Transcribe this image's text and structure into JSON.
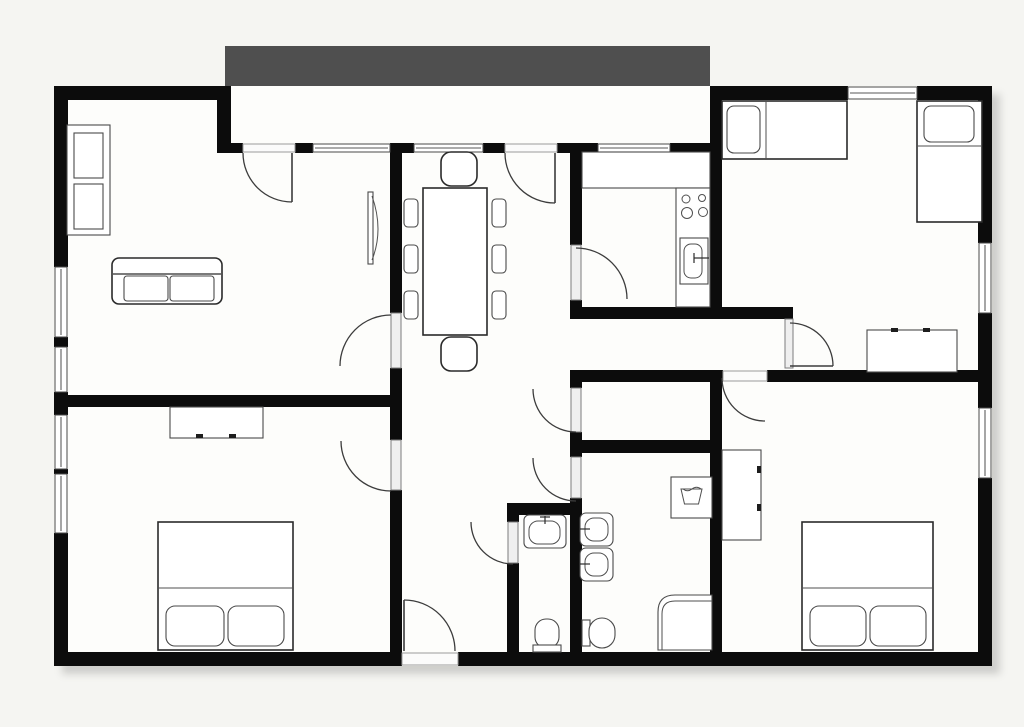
{
  "balcony": {
    "label": "Balkon / Balcony"
  },
  "colors": {
    "background": "#f5f5f2",
    "floor": "#fdfdfb",
    "wall": "#0c0c0c",
    "balcony": "#4f4f4f",
    "balcony_text": "#101010",
    "window_line": "#8f8f8f",
    "door_line": "#9b9b9b",
    "arc": "#3c3c3c",
    "furniture": "#2a2a2a",
    "fixture": "#4a4a4a"
  },
  "fixtures": {
    "living_room": [
      "wardrobe",
      "sofa",
      "tv"
    ],
    "dining_area": [
      "dining-table",
      "chair",
      "chair",
      "chair",
      "chair",
      "chair",
      "chair",
      "chair",
      "chair"
    ],
    "kitchen": [
      "counter",
      "stove",
      "kitchen-sink"
    ],
    "bedroom_top_right": [
      "single-bed",
      "single-bed",
      "dresser"
    ],
    "bedroom_bottom_right": [
      "wardrobe",
      "double-bed"
    ],
    "bedroom_bottom_left": [
      "dresser",
      "double-bed"
    ],
    "bathroom": [
      "sink",
      "sink",
      "washing-machine",
      "toilet",
      "corner-shower"
    ],
    "wc": [
      "sink",
      "toilet"
    ]
  }
}
